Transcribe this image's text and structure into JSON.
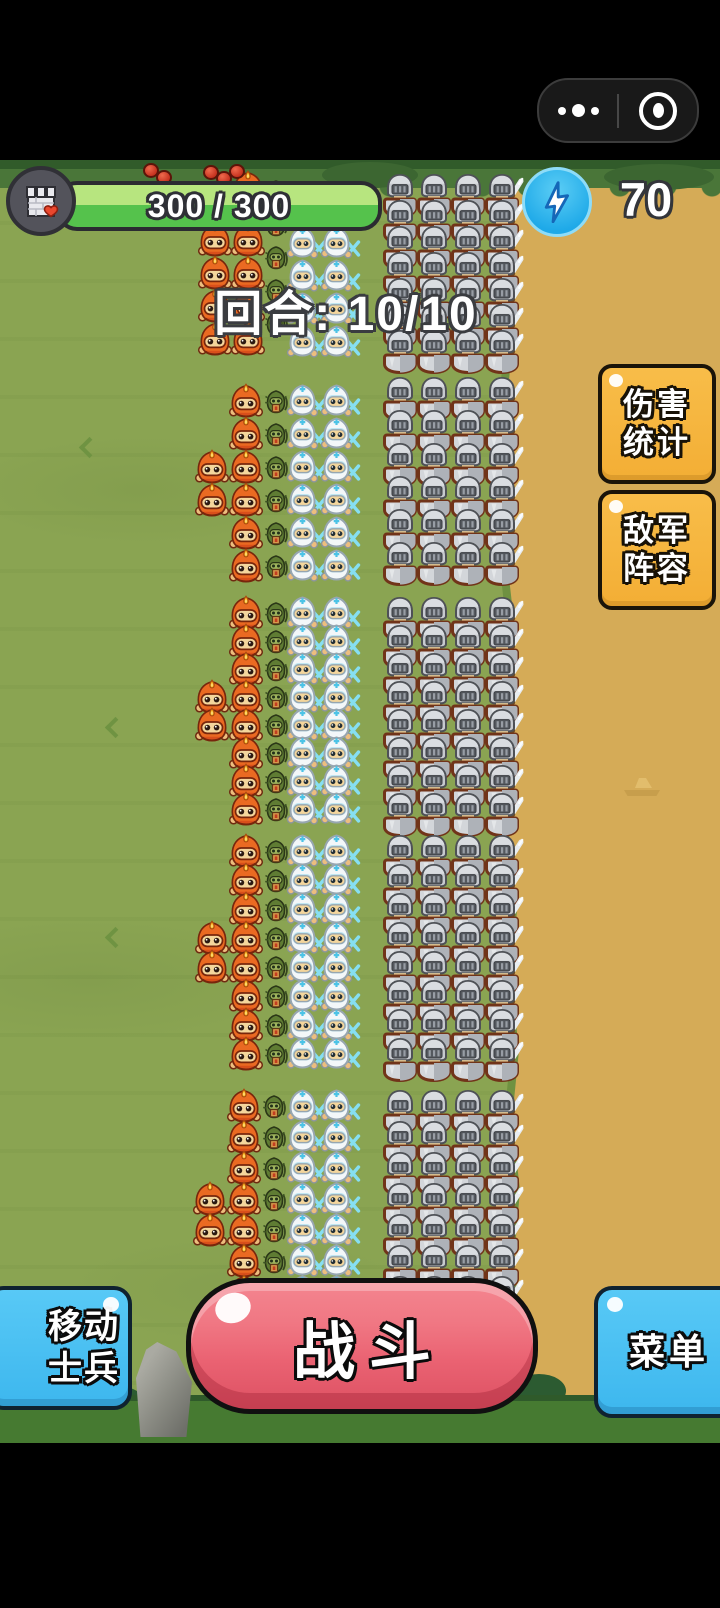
{
  "status_bar": {
    "capsule": {
      "more_icon": "ellipsis-icon",
      "minimize_icon": "record-circle-icon"
    }
  },
  "hud": {
    "castle_icon": "castle-health-icon",
    "health": {
      "current": 300,
      "max": 300,
      "label": "300 / 300"
    },
    "energy": {
      "icon": "lightning-icon",
      "value": "70"
    },
    "round_label": "回合: 10/10"
  },
  "side_buttons": {
    "damage_stats": {
      "lines": [
        "伤害",
        "统计"
      ]
    },
    "enemy_lineup": {
      "lines": [
        "敌军",
        "阵容"
      ]
    }
  },
  "bottom_buttons": {
    "move_soldiers": {
      "lines": [
        "移动",
        "士兵"
      ]
    },
    "battle": {
      "label": "战斗"
    },
    "menu": {
      "label": "菜单"
    }
  },
  "colors": {
    "grass": "#8AA452",
    "dirt": "#d5ab57",
    "health_bar_light": "#b7e57f",
    "health_bar_dark": "#55c24c",
    "energy_blue": "#1ea9e8",
    "gold_button": "#f6b941",
    "sky_button": "#4ac1f3",
    "battle_red": "#ea6272"
  },
  "units": {
    "legend": {
      "fire": "fire-mage-unit",
      "goblin": "forest-archer-unit",
      "ice": "ice-archer-unit",
      "knight": "enemy-knight-unit"
    },
    "formations": [
      {
        "type": "knight",
        "x": 380,
        "y": 172,
        "cols": 4,
        "rows": 7,
        "dx": 34,
        "dy": 26
      },
      {
        "type": "knight",
        "x": 380,
        "y": 375,
        "cols": 4,
        "rows": 6,
        "dx": 34,
        "dy": 33
      },
      {
        "type": "knight",
        "x": 380,
        "y": 595,
        "cols": 4,
        "rows": 8,
        "dx": 34,
        "dy": 28
      },
      {
        "type": "knight",
        "x": 380,
        "y": 833,
        "cols": 4,
        "rows": 8,
        "dx": 34,
        "dy": 29
      },
      {
        "type": "knight",
        "x": 380,
        "y": 1088,
        "cols": 4,
        "rows": 7,
        "dx": 34,
        "dy": 31
      },
      {
        "type": "fire",
        "x": 230,
        "y": 170,
        "cols": 1,
        "rows": 1,
        "dx": 0,
        "dy": 0
      },
      {
        "type": "fire",
        "x": 197,
        "y": 222,
        "cols": 2,
        "rows": 4,
        "dx": 33,
        "dy": 33
      },
      {
        "type": "goblin",
        "x": 264,
        "y": 179,
        "cols": 1,
        "rows": 5,
        "dx": 0,
        "dy": 33
      },
      {
        "type": "ice",
        "x": 286,
        "y": 192,
        "cols": 2,
        "rows": 5,
        "dx": 34,
        "dy": 33
      },
      {
        "type": "fire",
        "x": 194,
        "y": 449,
        "cols": 1,
        "rows": 2,
        "dx": 0,
        "dy": 33
      },
      {
        "type": "fire",
        "x": 228,
        "y": 383,
        "cols": 1,
        "rows": 6,
        "dx": 0,
        "dy": 33
      },
      {
        "type": "goblin",
        "x": 264,
        "y": 389,
        "cols": 1,
        "rows": 6,
        "dx": 0,
        "dy": 33
      },
      {
        "type": "ice",
        "x": 286,
        "y": 383,
        "cols": 2,
        "rows": 6,
        "dx": 34,
        "dy": 33
      },
      {
        "type": "fire",
        "x": 194,
        "y": 679,
        "cols": 1,
        "rows": 2,
        "dx": 0,
        "dy": 28
      },
      {
        "type": "fire",
        "x": 228,
        "y": 595,
        "cols": 1,
        "rows": 8,
        "dx": 0,
        "dy": 28
      },
      {
        "type": "goblin",
        "x": 264,
        "y": 601,
        "cols": 1,
        "rows": 8,
        "dx": 0,
        "dy": 28
      },
      {
        "type": "ice",
        "x": 286,
        "y": 595,
        "cols": 2,
        "rows": 8,
        "dx": 34,
        "dy": 28
      },
      {
        "type": "fire",
        "x": 194,
        "y": 920,
        "cols": 1,
        "rows": 2,
        "dx": 0,
        "dy": 29
      },
      {
        "type": "fire",
        "x": 228,
        "y": 833,
        "cols": 1,
        "rows": 8,
        "dx": 0,
        "dy": 29
      },
      {
        "type": "goblin",
        "x": 264,
        "y": 839,
        "cols": 1,
        "rows": 8,
        "dx": 0,
        "dy": 29
      },
      {
        "type": "ice",
        "x": 286,
        "y": 833,
        "cols": 2,
        "rows": 8,
        "dx": 34,
        "dy": 29
      },
      {
        "type": "fire",
        "x": 192,
        "y": 1181,
        "cols": 1,
        "rows": 2,
        "dx": 0,
        "dy": 31
      },
      {
        "type": "fire",
        "x": 226,
        "y": 1088,
        "cols": 1,
        "rows": 7,
        "dx": 0,
        "dy": 31
      },
      {
        "type": "goblin",
        "x": 262,
        "y": 1094,
        "cols": 1,
        "rows": 7,
        "dx": 0,
        "dy": 31
      },
      {
        "type": "ice",
        "x": 286,
        "y": 1088,
        "cols": 2,
        "rows": 7,
        "dx": 34,
        "dy": 31
      }
    ]
  }
}
